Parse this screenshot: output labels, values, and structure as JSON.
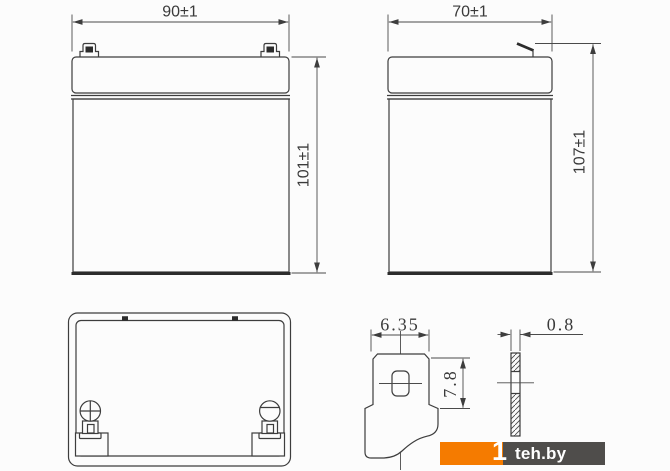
{
  "drawing": {
    "front_view": {
      "width_label": "90±1",
      "height_label": "101±1"
    },
    "side_view": {
      "width_label": "70±1",
      "height_label": "107±1"
    },
    "terminal_front_detail": {
      "width_label": "6.35",
      "height_label": "7.8"
    },
    "terminal_side_detail": {
      "thickness_label": "0.8"
    }
  },
  "watermark": {
    "logo_digit": "1",
    "site": "teh.by",
    "orange_color": "#F57B00",
    "dark_color": "#4F4D4B"
  },
  "colors": {
    "background": "#FCFCFC",
    "line": "#3D3D3D",
    "dimension_text": "#3A3A3A"
  }
}
